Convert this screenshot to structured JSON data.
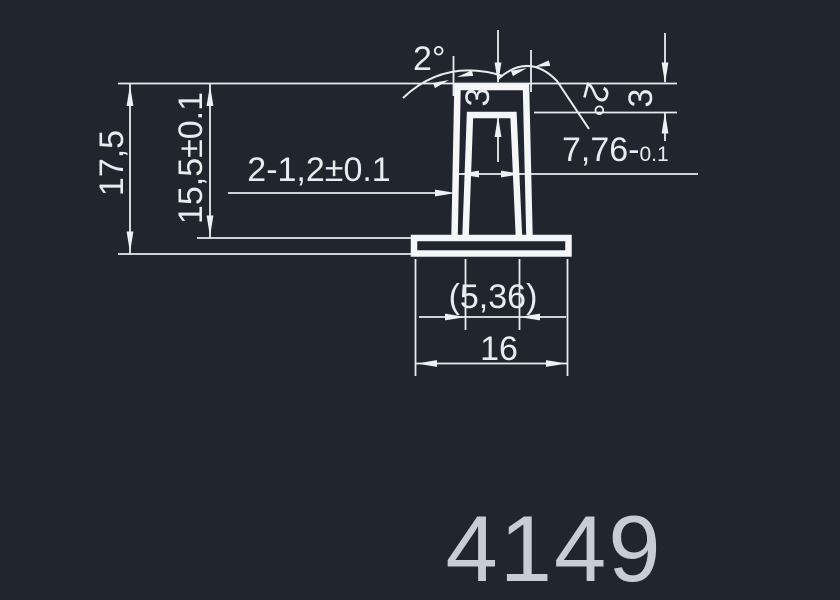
{
  "drawing": {
    "part_number": "4149",
    "dims": {
      "total_height": "17,5",
      "body_height": "15,5±0.1",
      "wall_thickness": "2-1,2±0.1",
      "outer_width": "7,76-",
      "outer_width_tol": "0.1",
      "top_thickness": "3",
      "side_thickness": "3",
      "draft_left": "2°",
      "draft_right": "2°",
      "inner_width_ref": "(5,36)",
      "base_width": "16"
    },
    "colors": {
      "background": "#21252d",
      "lines": "#e9ecef",
      "profile": "#f4f6f8",
      "part_number": "#c7cdd5"
    }
  }
}
